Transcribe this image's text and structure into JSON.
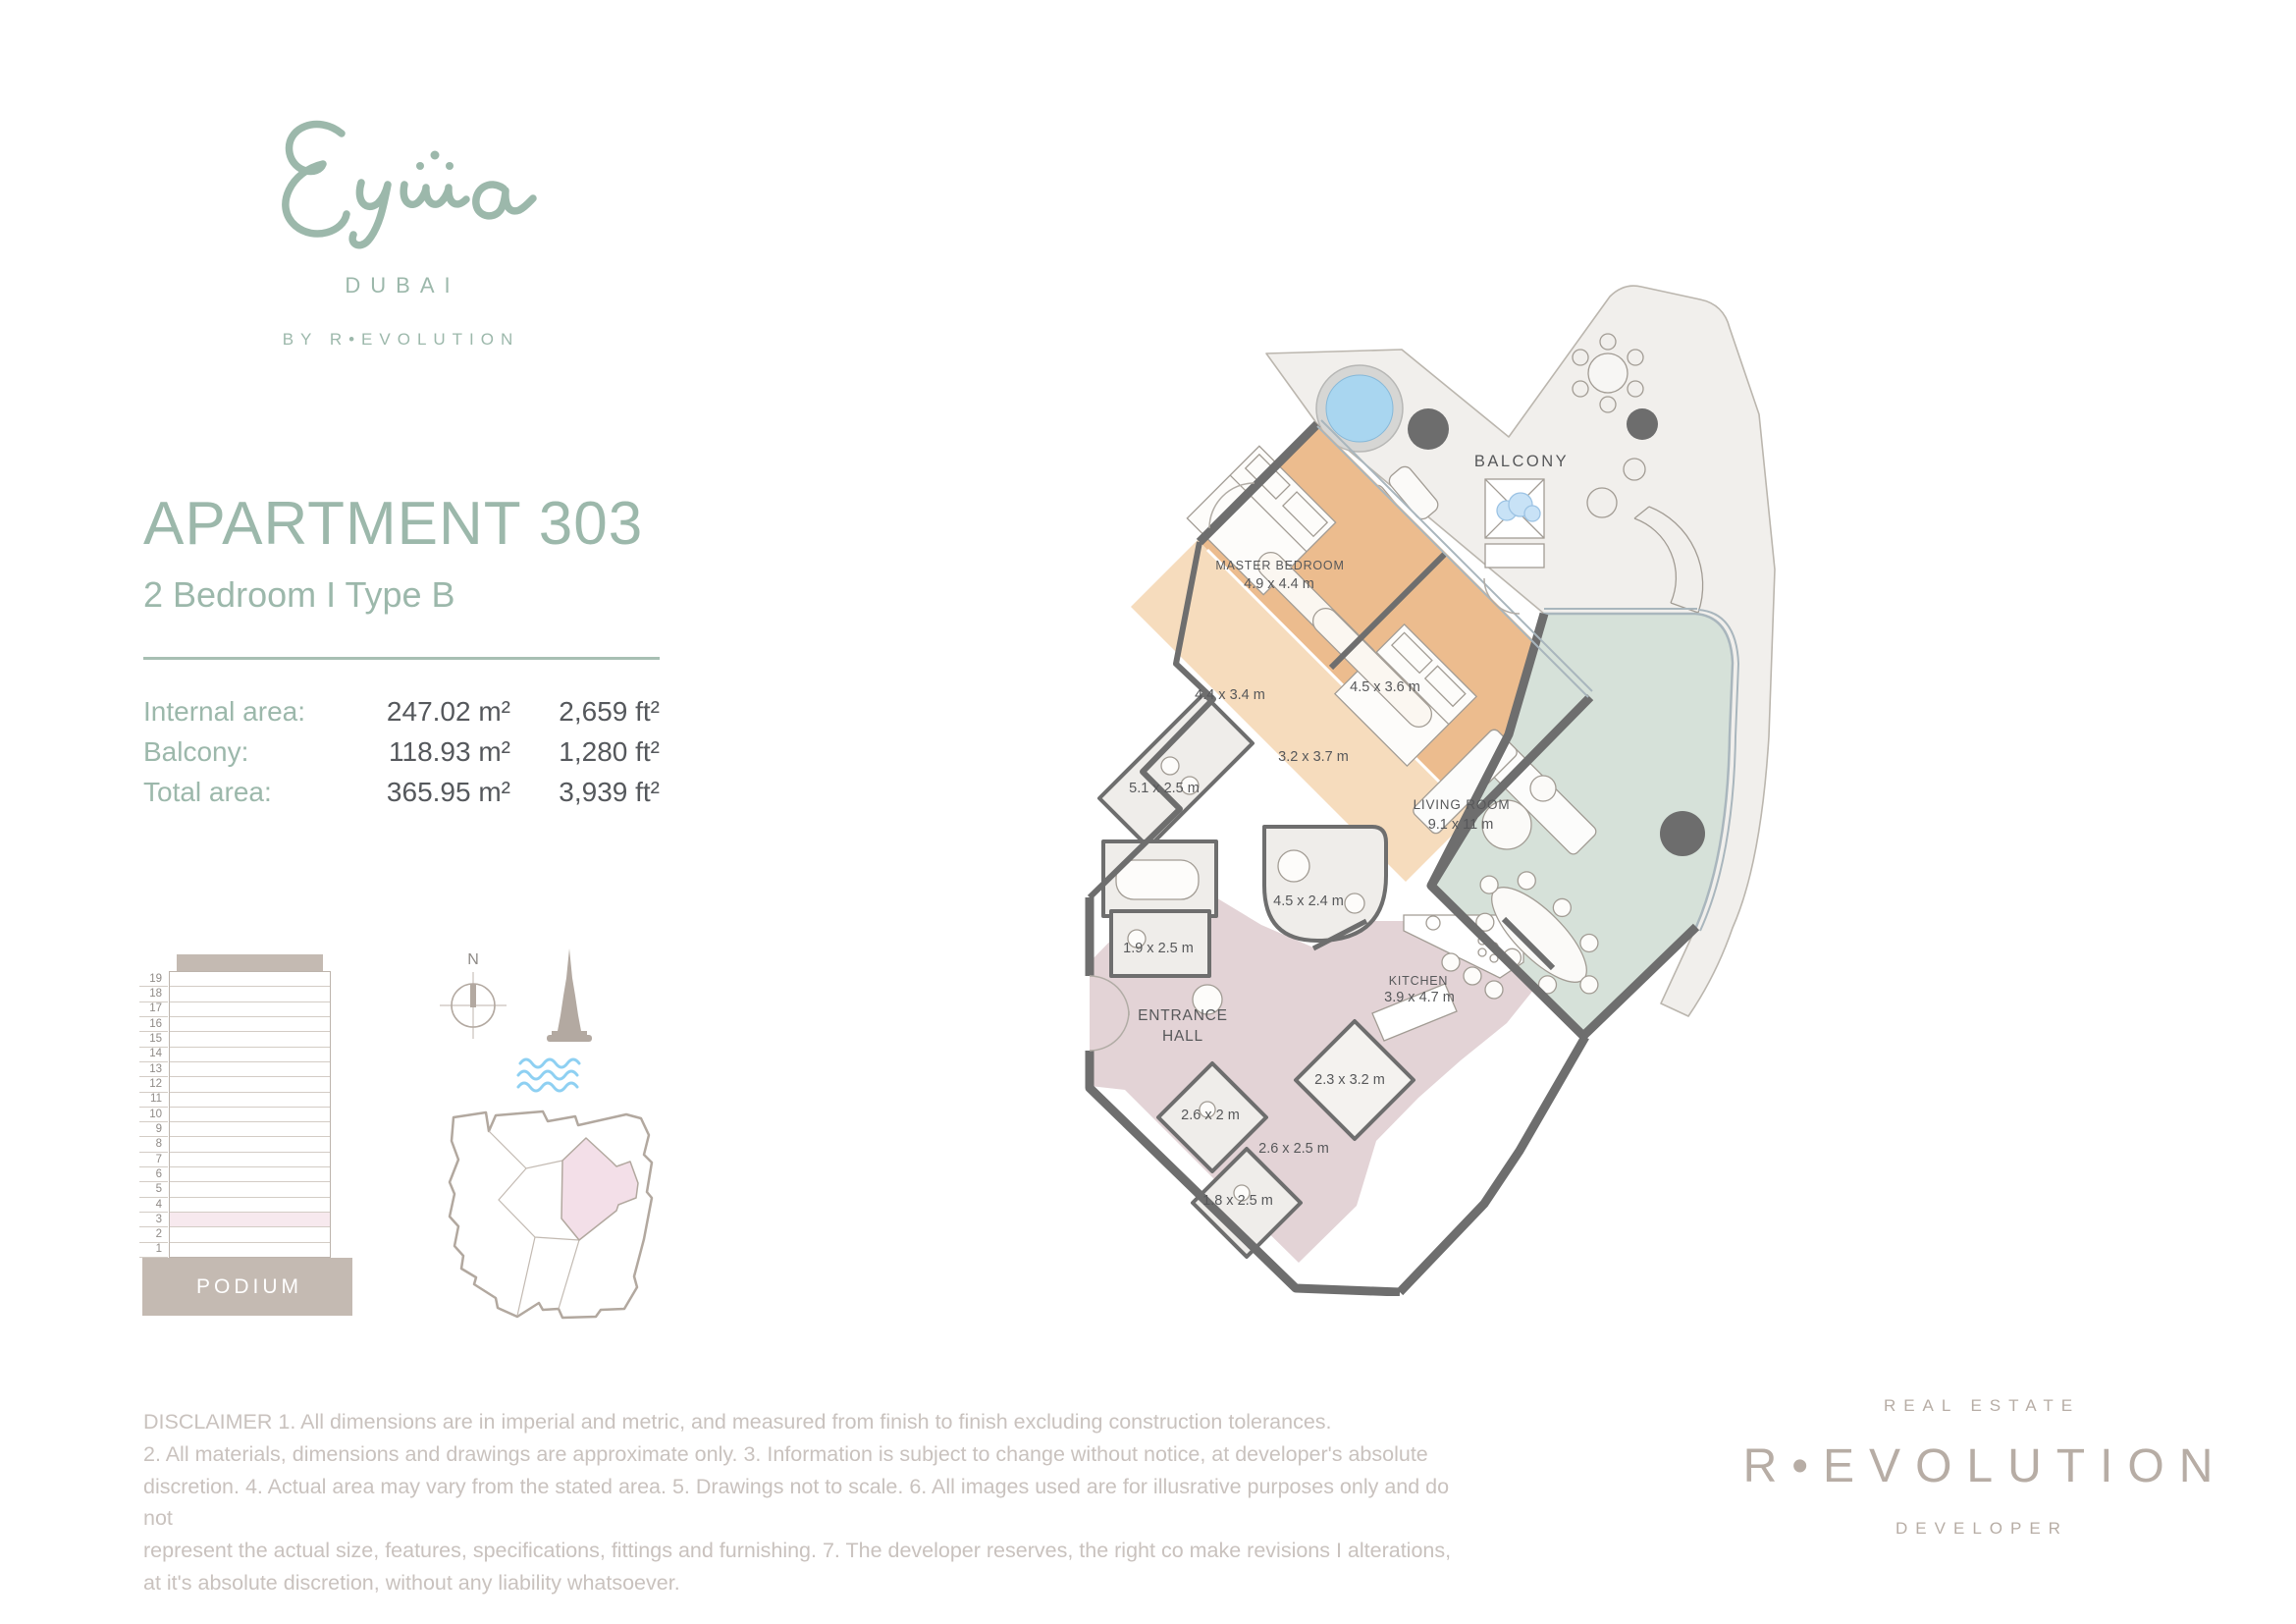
{
  "brand": {
    "logo_text": "Eywa",
    "city": "DUBAI",
    "byline": "BY R•EVOLUTION"
  },
  "apartment": {
    "title": "APARTMENT 303",
    "subtitle": "2 Bedroom  I  Type B",
    "areas": [
      {
        "label": "Internal area:",
        "metric": "247.02 m²",
        "imperial": "2,659 ft²"
      },
      {
        "label": "Balcony:",
        "metric": "118.93 m²",
        "imperial": "1,280 ft²"
      },
      {
        "label": "Total area:",
        "metric": "365.95 m²",
        "imperial": "3,939 ft²"
      }
    ]
  },
  "elevation": {
    "floors": [
      "19",
      "18",
      "17",
      "16",
      "15",
      "14",
      "13",
      "12",
      "11",
      "10",
      "9",
      "8",
      "7",
      "6",
      "5",
      "4",
      "3",
      "2",
      "1"
    ],
    "highlighted_floor": "3",
    "podium_label": "PODIUM"
  },
  "locator": {
    "compass_label": "N"
  },
  "plan": {
    "labels": {
      "balcony": "BALCONY",
      "master_name": "MASTER BEDROOM",
      "master_dims": "4.9 x 4.4 m",
      "dressing1": "4.4 x 3.4 m",
      "bedroom2": "4.5 x 3.6 m",
      "dressing2": "3.2 x 3.7 m",
      "master_bath": "5.1 x 2.5 m",
      "living_name": "LIVING ROOM",
      "living_dims": "9.1 x 11 m",
      "bath2": "4.5 x 2.4 m",
      "closet": "1.9 x 2.5 m",
      "hall_line1": "ENTRANCE",
      "hall_line2": "HALL",
      "kitchen_name": "KITCHEN",
      "kitchen_dims": "3.9 x 4.7 m",
      "utility": "2.3 x 3.2 m",
      "powder": "2.6 x 2 m",
      "store": "2.6 x 2.5 m",
      "guest_bath": "1.8 x 2.5 m"
    }
  },
  "disclaimer": {
    "lines": [
      "DISCLAIMER  1. All dimensions are in imperial and metric, and measured from finish to finish excluding construction tolerances.",
      "2. All materials, dimensions and drawings are approximate only. 3. Information is subject to change without notice, at developer's absolute",
      "discretion. 4. Actual area may vary from the stated area. 5. Drawings not to scale. 6. All images used are for illusrative purposes only and do not",
      "represent the actual size, features, specifications, fittings and furnishing. 7. The developer reserves, the right co make revisions I alterations,",
      "at it's absolute discretion, without any liability whatsoever."
    ]
  },
  "developer": {
    "top": "REAL ESTATE",
    "name": "R•EVOLUTION",
    "bottom": "DEVELOPER"
  },
  "colors": {
    "sage": "#9cb8ab",
    "taupe": "#b7ada5",
    "highlight_pink": "#f7e9ee",
    "plan_orange": "#ecbc8e",
    "plan_light_orange": "#f6dcbd",
    "plan_sage": "#d6e1d9",
    "plan_mauve": "#e3d3d6",
    "pool_blue": "#a9d6f0",
    "wave_blue": "#8ed0f2",
    "wall_gray": "#6e6e6e"
  }
}
